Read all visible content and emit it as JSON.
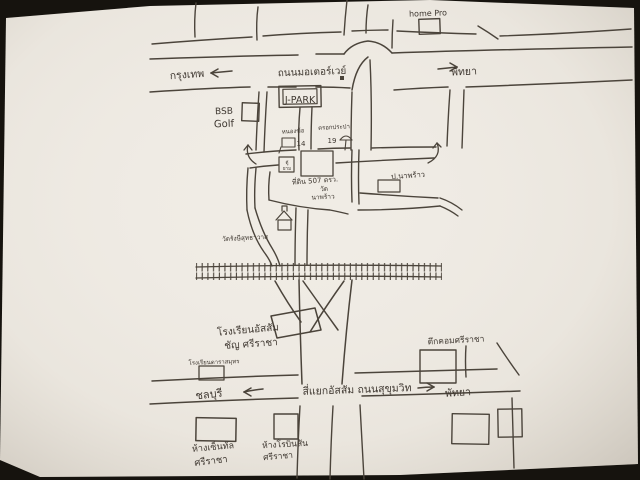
{
  "labels": {
    "top": {
      "store": "home Pro",
      "dir_left": "กรุงเทพ",
      "road": "ถนนมอเตอร์เวย์",
      "dir_right": "พัทยา",
      "golf_line1": "BSB",
      "golf_line2": "Golf",
      "jpark": "J-PARK"
    },
    "middle": {
      "soi_left_name": "หนองฆ้อ",
      "soi_left_number": "14",
      "soi_right_name": "ตรอกประปา",
      "soi_right_number": "19",
      "guard_line1": "ตู้",
      "guard_line2": "ยาม",
      "land_line1": "ที่ดิน 507 ตรว.",
      "land_line2": "วัด",
      "land_line3": "นาพร้าว",
      "place_right": "ป.นาพร้าว",
      "temple": "วัดรังษีสุทธาวาส"
    },
    "bottom": {
      "school_line1": "โรงเรียนอัสสัม",
      "school_line2": "ชัญ ศรีราชา",
      "school_sign": "โรงเรียนดาราสมุทร",
      "dir_left": "ชลบุรี",
      "junction": "สี่แยกอัสสัม ถนนสุขุมวิท",
      "dir_right": "พัทยา",
      "tukcom": "ตึกคอมศรีราชา",
      "central_line1": "ห้างเซ็นทัล",
      "central_line2": "ศรีราชา",
      "robinson_line1": "ห้างโรบินสัน",
      "robinson_line2": "ศรีราชา"
    }
  },
  "colors": {
    "ink": "#4b443b",
    "paper": "#f0ece5",
    "background": "#16130e"
  }
}
